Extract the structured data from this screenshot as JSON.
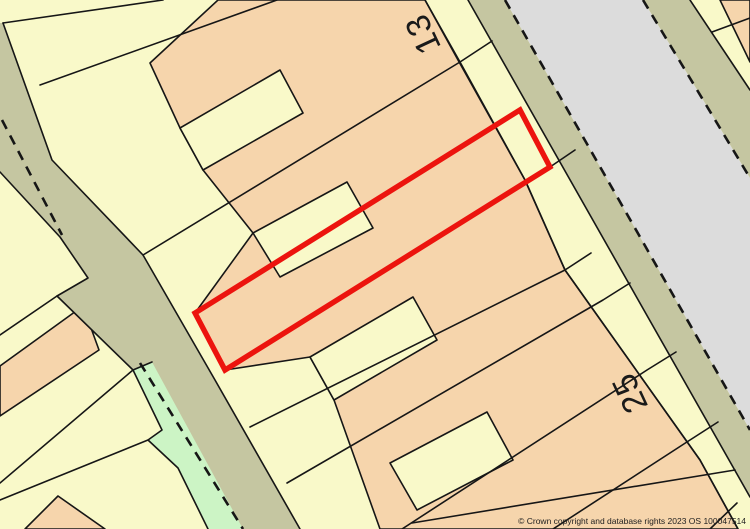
{
  "map": {
    "labels": {
      "plot_13": "13",
      "plot_25": "25"
    },
    "copyright": "© Crown copyright and database rights 2023 OS 100047514"
  },
  "colors": {
    "parcel-yellow": "#f9f9c9",
    "building-peach": "#f6d5ac",
    "road-olive": "#c5c6a1",
    "road-gray": "#dcdcdc",
    "verge-green": "#ccf4c5",
    "highlight-red": "#ec140e",
    "line-black": "#161616"
  }
}
